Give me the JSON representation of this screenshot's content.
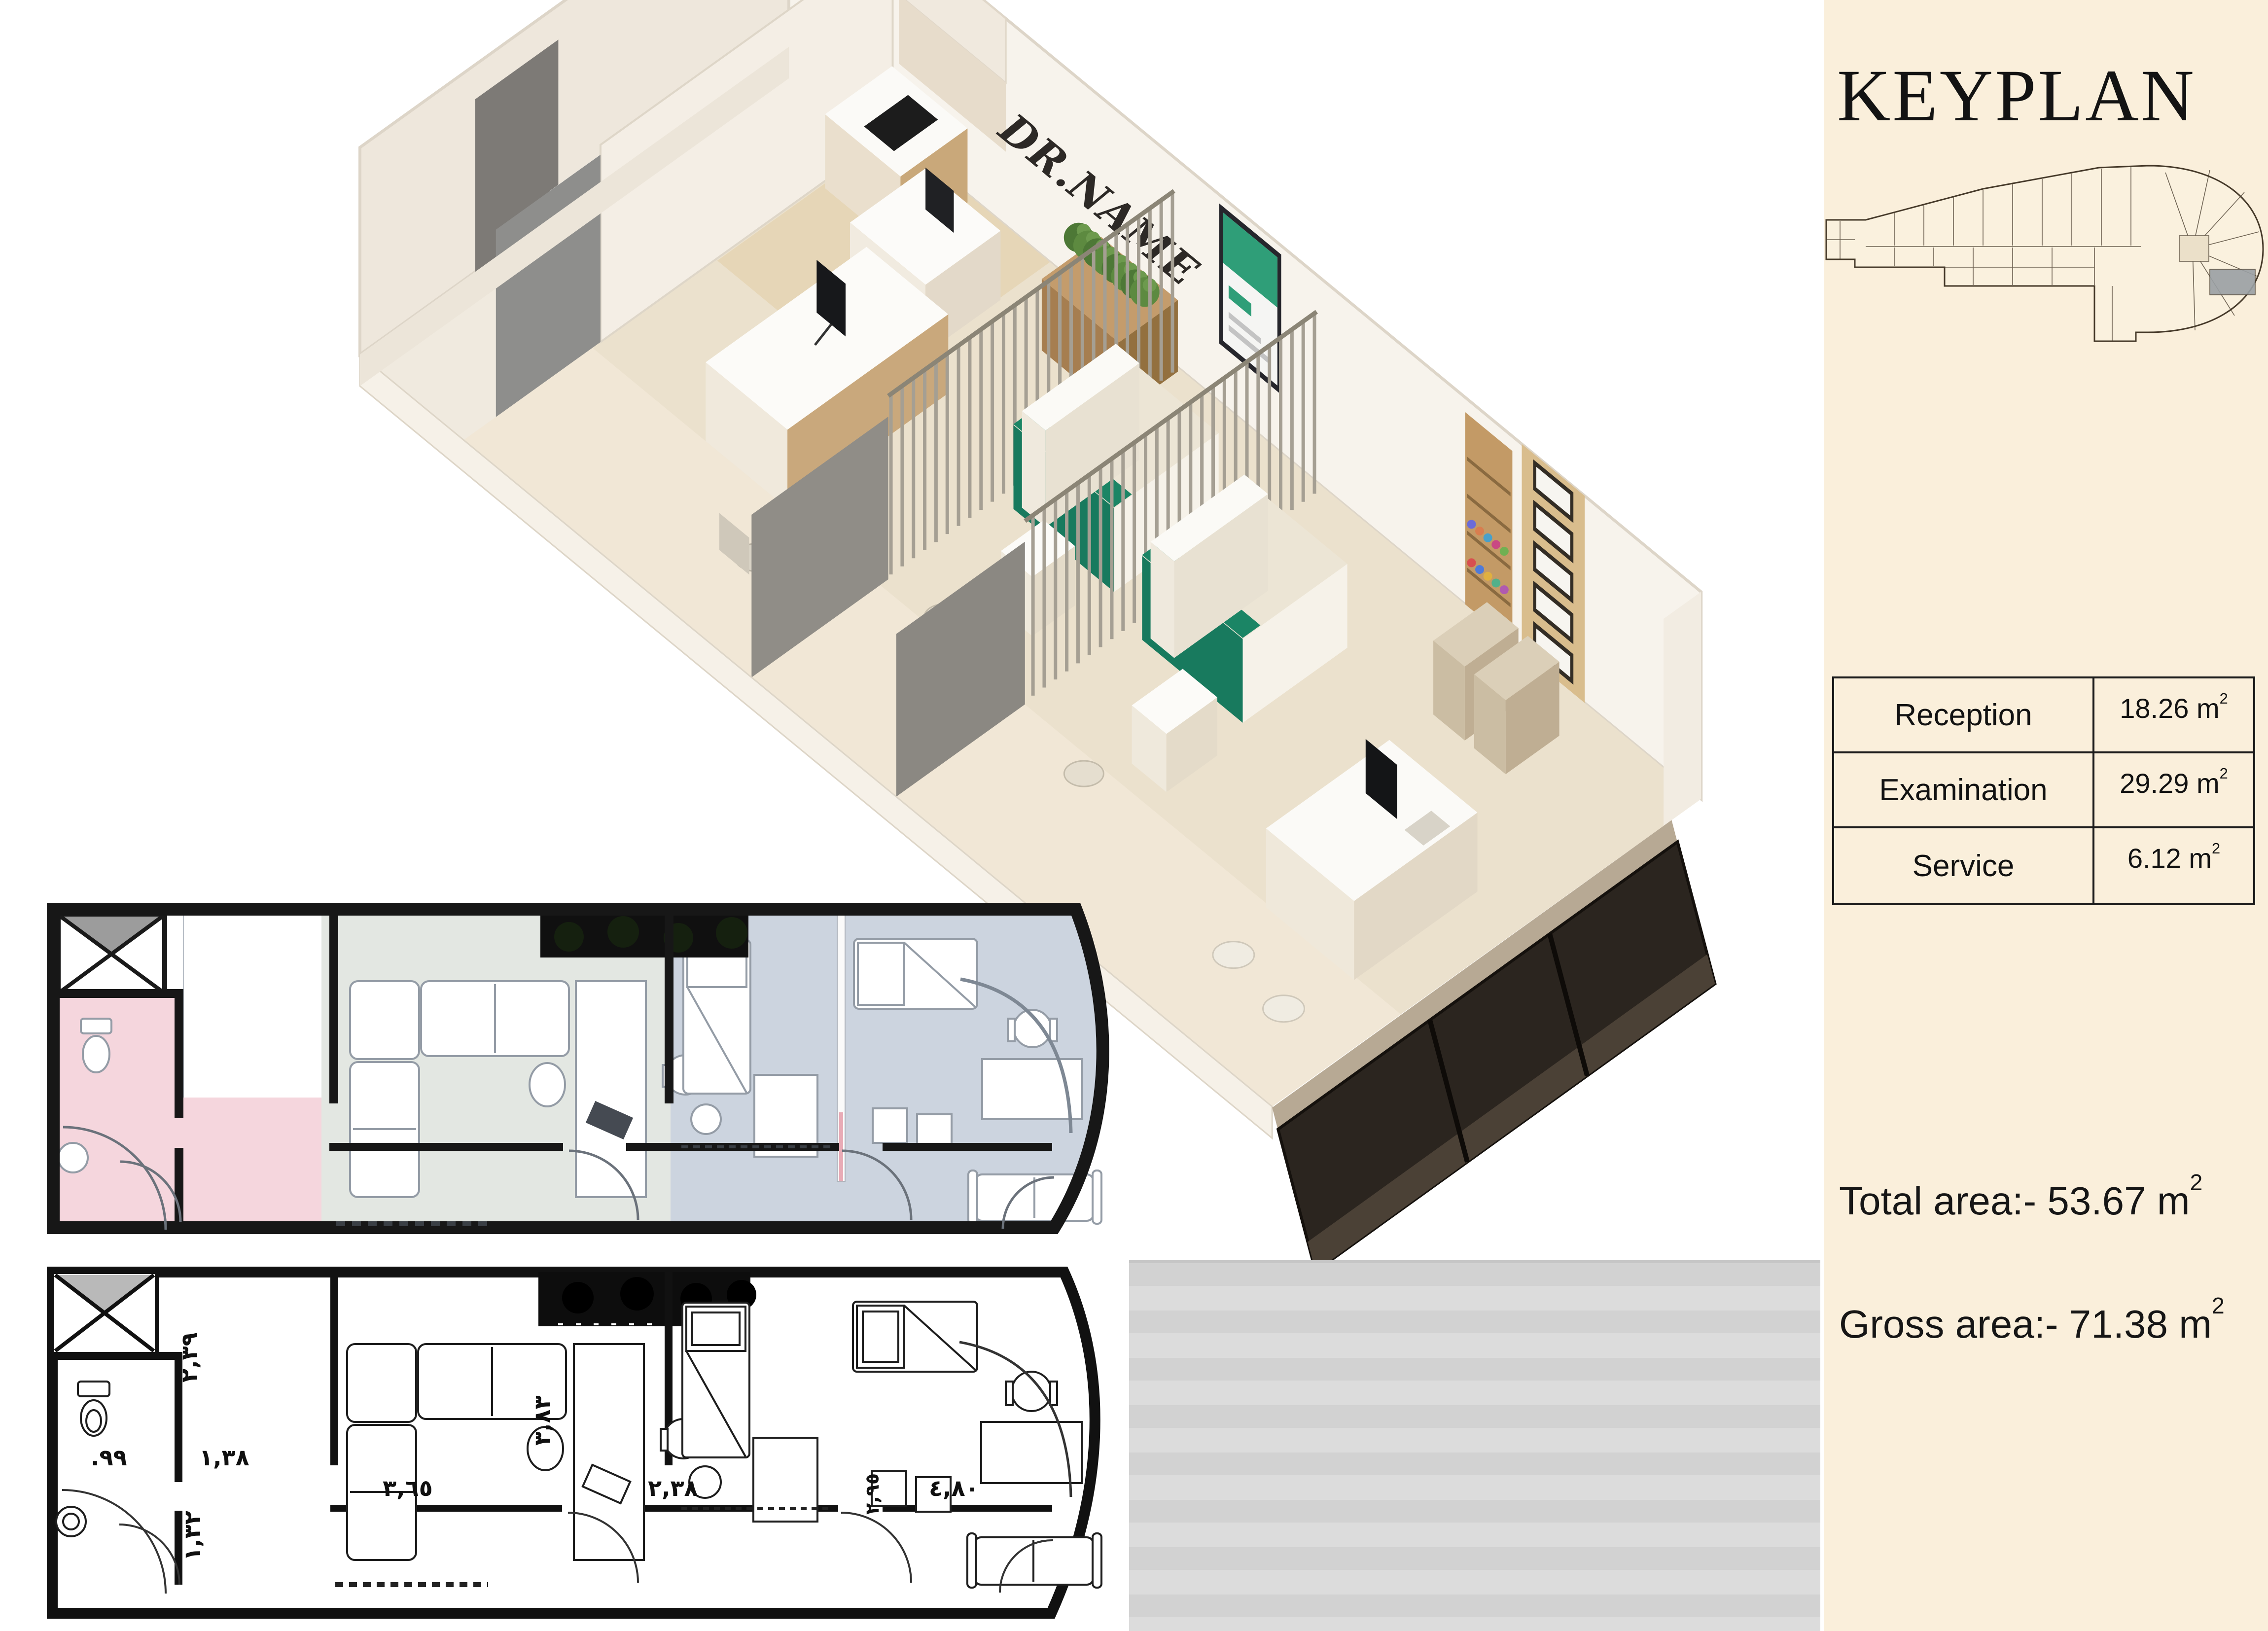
{
  "page": {
    "background": "#ffffff",
    "backdrop_gray": "#d6d6d6"
  },
  "sidebar": {
    "background": "#faefdb",
    "title": "KEYPLAN",
    "areas_table": {
      "rows": [
        {
          "label": "Reception",
          "value": "18.26 m",
          "sup": "2"
        },
        {
          "label": "Examination",
          "value": "29.29 m",
          "sup": "2"
        },
        {
          "label": "Service",
          "value": "6.12 m",
          "sup": "2"
        }
      ]
    },
    "total_area": {
      "text": "Total area:- 53.67 m",
      "sup": "2"
    },
    "gross_area": {
      "text": "Gross area:- 71.38 m",
      "sup": "2"
    }
  },
  "render_3d": {
    "wall_text": "DR.NAME",
    "accent_green": "#187a5e",
    "glass_color": "#2b251f",
    "floor_color": "#ebe1cd"
  },
  "plan_colored": {
    "bathroom_color": "#f5d6dd",
    "reception_color": "#e3e7e2",
    "examination_color": "#ccd4df",
    "wall_color": "#171717"
  },
  "plan_bw": {
    "dims": [
      {
        "text": "٢,٣٩"
      },
      {
        "text": ".٩٩"
      },
      {
        "text": "١,٣٨"
      },
      {
        "text": "٣,٦٥"
      },
      {
        "text": "٣,٨٣"
      },
      {
        "text": "٢,٣٨"
      },
      {
        "text": "٢,٩٥"
      },
      {
        "text": "٤,٨٠"
      },
      {
        "text": "١,٣٢"
      }
    ]
  }
}
